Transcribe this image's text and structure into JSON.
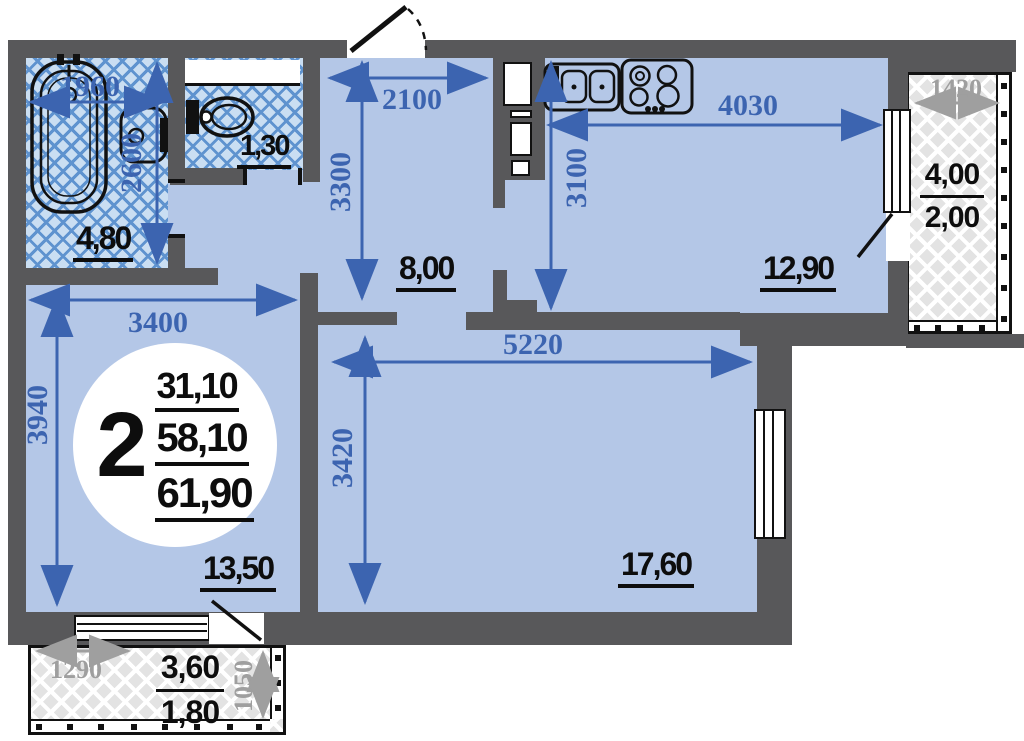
{
  "title": "2-room apartment floor plan",
  "unit_badge": {
    "rooms_count": "2",
    "living_area": "31,10",
    "total_area": "58,10",
    "overall_area": "61,90"
  },
  "rooms": {
    "bathroom": {
      "area": "4,80",
      "width": "1960",
      "depth": "2600"
    },
    "toilet": {
      "area": "1,30"
    },
    "hallway": {
      "area": "8,00",
      "width": "2100",
      "depth": "3300"
    },
    "kitchen": {
      "area": "12,90",
      "width": "4030",
      "depth": "3100"
    },
    "bedroom": {
      "area": "13,50",
      "width": "3400",
      "depth": "3940"
    },
    "living_room": {
      "area": "17,60",
      "width": "5220",
      "depth": "3420"
    },
    "balcony_right": {
      "width": "1420",
      "area_total": "4,00",
      "area_counted": "2,00"
    },
    "balcony_bottom": {
      "width": "1290",
      "depth": "1050",
      "area_total": "3,60",
      "area_counted": "1,80"
    }
  },
  "colors": {
    "paper": "#ffffff",
    "floor": "#b4c7e7",
    "wall": "#58585a",
    "dim": "#3c64b0",
    "dimmuted": "#9f9f9f",
    "tilebg": "#cadef2",
    "tileline": "#5f93cf",
    "balcbg": "#e3e3e3",
    "balcline": "#ffffff",
    "ink": "#0d0d0d"
  }
}
